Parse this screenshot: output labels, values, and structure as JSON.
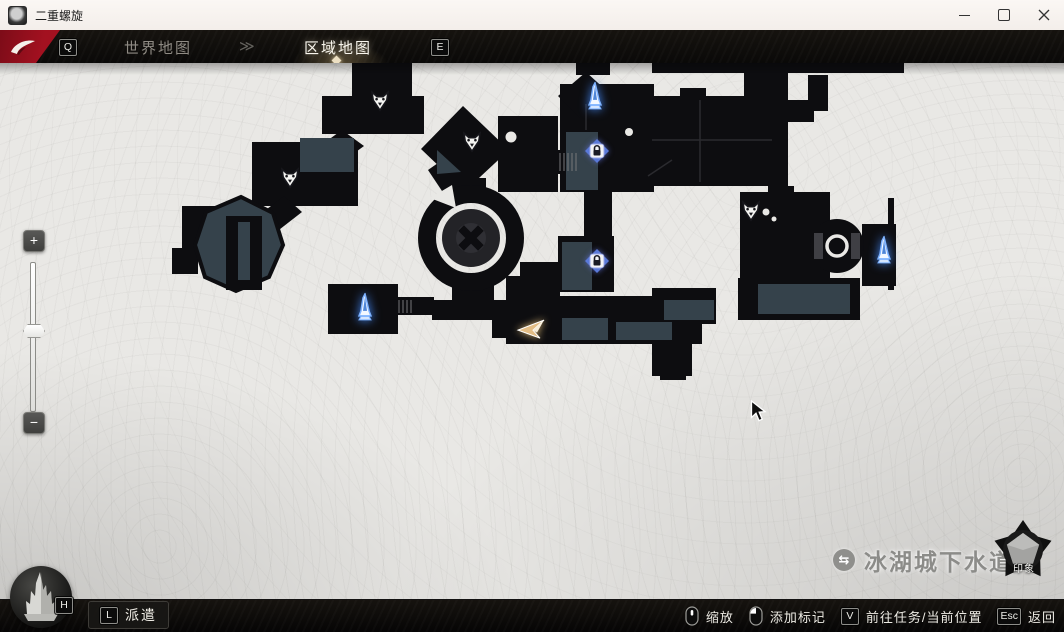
{
  "window": {
    "title": "二重螺旋"
  },
  "nav": {
    "separator_icon": "≫",
    "tabs": [
      {
        "shortcut": "Q",
        "label": "世界地图",
        "active": false
      },
      {
        "shortcut": "E",
        "label": "区域地图",
        "active": true
      }
    ]
  },
  "map": {
    "zoom_in": "+",
    "zoom_out": "−",
    "location": {
      "switch_icon": "⇆",
      "label": "冰湖城下水道"
    },
    "compass": {
      "label": "印象"
    },
    "markers": [
      {
        "type": "waypoint",
        "x": 595,
        "y": 100
      },
      {
        "type": "waypoint",
        "x": 365,
        "y": 311
      },
      {
        "type": "waypoint",
        "x": 884,
        "y": 254
      },
      {
        "type": "locked",
        "x": 597,
        "y": 155
      },
      {
        "type": "locked",
        "x": 597,
        "y": 265
      },
      {
        "type": "enemy",
        "x": 380,
        "y": 105
      },
      {
        "type": "enemy",
        "x": 472,
        "y": 146
      },
      {
        "type": "enemy",
        "x": 290,
        "y": 182
      },
      {
        "type": "enemy",
        "x": 751,
        "y": 215
      },
      {
        "type": "player",
        "x": 531,
        "y": 333
      }
    ]
  },
  "bottom_bar": {
    "emblem_shortcut": "H",
    "dispatch": {
      "shortcut": "L",
      "label": "派遣"
    },
    "hints": [
      {
        "icon": "mouse-scroll-icon",
        "label": "缩放"
      },
      {
        "icon": "mouse-button-icon",
        "label": "添加标记"
      },
      {
        "shortcut": "V",
        "label": "前往任务/当前位置"
      },
      {
        "shortcut": "Esc",
        "label": "返回"
      }
    ]
  }
}
